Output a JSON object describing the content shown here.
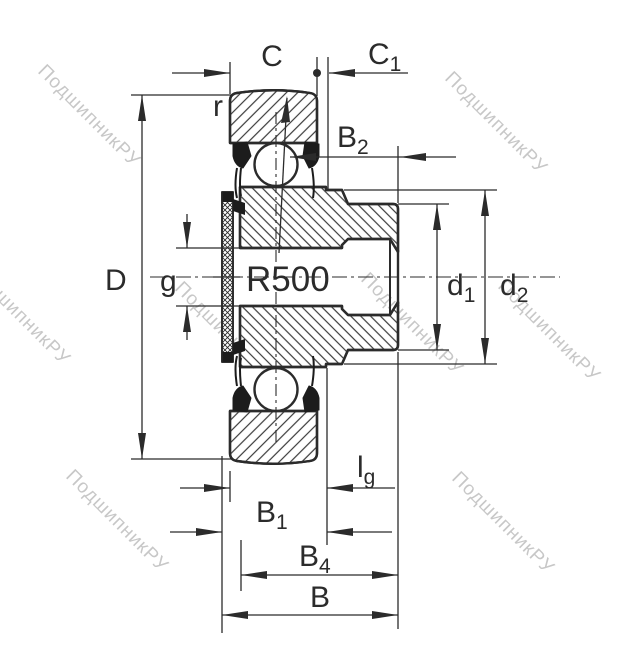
{
  "figure": {
    "type": "technical-drawing",
    "subject": "radial insert ball bearing with hex bore, cross-section with dimension lines"
  },
  "watermark": {
    "text": "ПодшипникРУ"
  },
  "dims": {
    "c": {
      "label": "C"
    },
    "c1": {
      "base": "C",
      "sub": "1"
    },
    "r": {
      "label": "r"
    },
    "b2": {
      "base": "B",
      "sub": "2"
    },
    "d": {
      "label": "D"
    },
    "g": {
      "label": "g"
    },
    "radius": {
      "label": "R500"
    },
    "d1": {
      "base": "d",
      "sub": "1"
    },
    "d2": {
      "base": "d",
      "sub": "2"
    },
    "lg": {
      "base": "l",
      "sub": "g"
    },
    "b1": {
      "base": "B",
      "sub": "1"
    },
    "b4": {
      "base": "B",
      "sub": "4"
    },
    "b": {
      "label": "B"
    }
  },
  "colors": {
    "line": "#2b2b2b",
    "hatch": "#3a3a3a",
    "seal": "#1c1c1c",
    "watermark": "#9b9b9b",
    "background": "#ffffff"
  }
}
